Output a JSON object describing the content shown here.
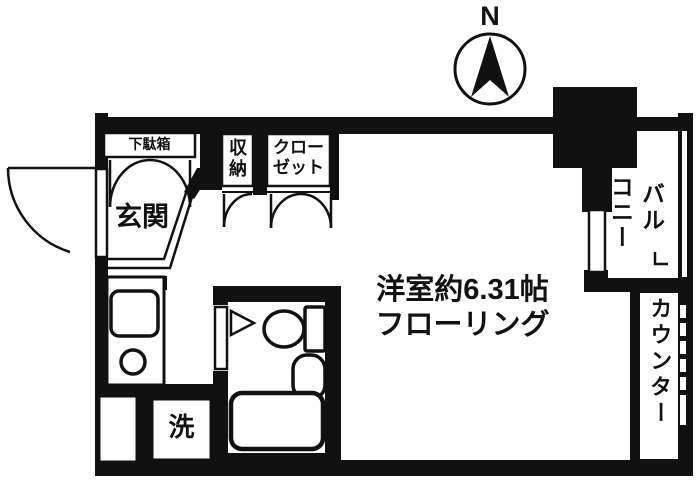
{
  "labels": {
    "compass_north": "N",
    "shoe_box": "下駄箱",
    "storage": "収納",
    "closet_line1": "クロー",
    "closet_line2": "ゼット",
    "entrance": "玄関",
    "room_size": "洋室約6.31帖",
    "room_floor": "フローリング",
    "washer": "洗",
    "balcony_col_right": "バル",
    "balcony_col_left": "コニー",
    "counter": "カウンター"
  },
  "colors": {
    "ink": "#111111",
    "paper": "#ffffff"
  }
}
